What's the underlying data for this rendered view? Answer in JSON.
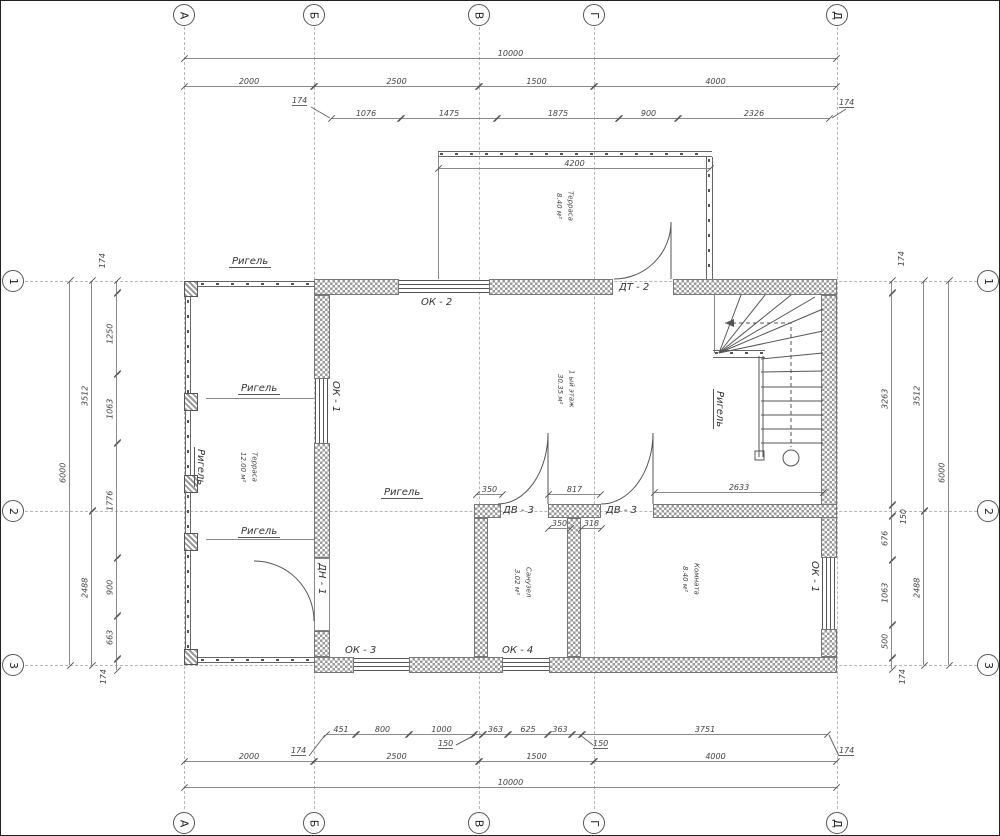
{
  "title": "План 1-го этажа",
  "axes": {
    "cols": [
      "А",
      "Б",
      "В",
      "Г",
      "Д"
    ],
    "rows": [
      "1",
      "2",
      "3"
    ]
  },
  "dims": {
    "top_total": "10000",
    "top_chain2": [
      "2000",
      "2500",
      "1500",
      "4000"
    ],
    "top_chain3": [
      "1076",
      "1475",
      "1875",
      "900",
      "2326"
    ],
    "t174l": "174",
    "t174r": "174",
    "terrace_width": "4200",
    "bot_chain": [
      "451",
      "800",
      "1000",
      "363",
      "625",
      "363",
      "3751"
    ],
    "b174l": "174",
    "b150a": "150",
    "b150b": "150",
    "b174r": "174",
    "bot_chain2": [
      "2000",
      "2500",
      "1500",
      "4000"
    ],
    "bot_total": "10000",
    "left_chain": [
      "1250",
      "1063",
      "1776",
      "900",
      "663"
    ],
    "l174t": "174",
    "l174b": "174",
    "left_chain2": [
      "3512",
      "2488"
    ],
    "left_total": "6000",
    "right_chain": [
      "3263",
      "676",
      "1063",
      "500"
    ],
    "r174t": "174",
    "r150": "150",
    "r174b": "174",
    "right_chain2": [
      "3512",
      "2488"
    ],
    "right_total": "6000",
    "stair": "2633",
    "d350a": "350",
    "d817": "817",
    "d350b": "350",
    "d318": "318"
  },
  "rooms": [
    {
      "name": "Терраса",
      "area": "8.40 м²"
    },
    {
      "name": "1 ый этаж",
      "area": "30.35 м²"
    },
    {
      "name": "Терраса",
      "area": "12.00 м²"
    },
    {
      "name": "Санузел",
      "area": "3.02 м²"
    },
    {
      "name": "Комната",
      "area": "8.40 м²"
    }
  ],
  "openings": {
    "ok1": "ОК - 1",
    "ok2": "ОК - 2",
    "ok3": "ОК - 3",
    "ok4": "ОК - 4",
    "dt2": "ДТ - 2",
    "dv3": "ДВ - 3",
    "dn1": "ДН - 1"
  },
  "beam_label": "Ригель",
  "colors": {
    "line": "#555555",
    "hatch": "#9a9a9a",
    "background": "#ffffff"
  }
}
